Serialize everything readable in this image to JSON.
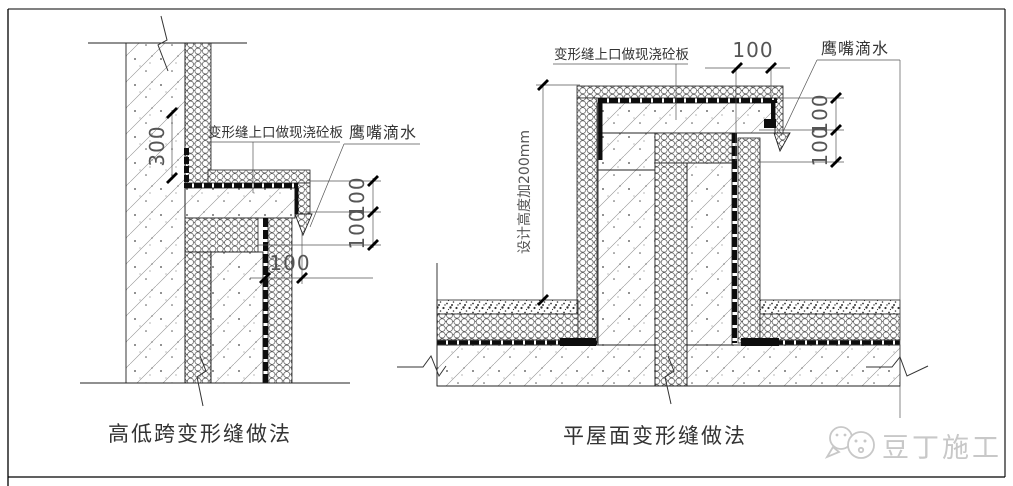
{
  "drawing": {
    "left_detail": {
      "caption": "高低跨变形缝做法",
      "labels": {
        "slab": "变形缝上口做现浇砼板",
        "drip": "鹰嘴滴水"
      },
      "dims": {
        "parapet_height": "300",
        "step_upper": "100",
        "step_lower": "100",
        "joint_width": "100"
      }
    },
    "right_detail": {
      "caption": "平屋面变形缝做法",
      "labels": {
        "slab": "变形缝上口做现浇砼板",
        "drip": "鹰嘴滴水",
        "height_note": "设计高度加200mm"
      },
      "dims": {
        "cap_width": "100",
        "step_upper": "100",
        "step_lower": "100"
      }
    },
    "watermark": {
      "text": "豆丁施工",
      "color": "#c8c8c8"
    },
    "colors": {
      "line": "#1a1a1a",
      "background": "#ffffff"
    }
  }
}
